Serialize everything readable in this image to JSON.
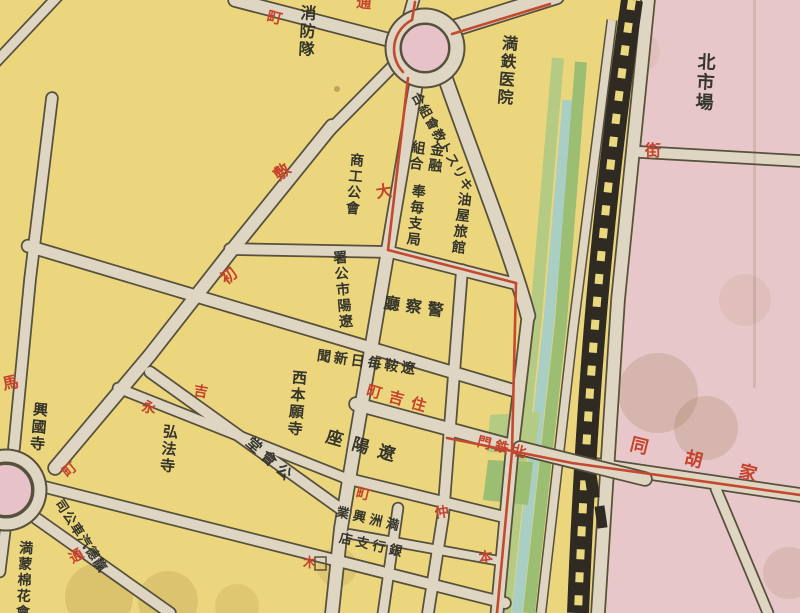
{
  "colors": {
    "paper_yellow": "#ebd67d",
    "district_pink": "#e8c7ca",
    "roundabout_pink": "#e7c3c9",
    "road_fill": "#ded5c2",
    "road_casing": "#56503c",
    "green_strip_light": "#b5ca82",
    "green_strip_dark": "#9cbe73",
    "canal_teal": "#a9cfc4",
    "railway_black": "#2f2b22",
    "railway_dash_yellow": "#ead87f",
    "ink_black": "#35352c",
    "ink_red": "#c5432d",
    "tram_red": "#c5492f"
  },
  "labels": [
    {
      "name": "fire-brigade-label",
      "display": "消防隊",
      "reading": "消防隊",
      "color": "black",
      "dir": "v",
      "x": 297,
      "y": 4,
      "size": 16,
      "rot": 3
    },
    {
      "name": "mantetsu-hospital-label",
      "display": "満鉄医院",
      "reading": "満鉄医院",
      "color": "black",
      "dir": "v",
      "x": 499,
      "y": 34,
      "size": 16,
      "rot": 5
    },
    {
      "name": "christian-church-union-label",
      "display": "合組會教トスリキ",
      "reading": "キリスト教會組合",
      "color": "black",
      "dir": "h",
      "x": 421,
      "y": 90,
      "size": 13,
      "rot": 61
    },
    {
      "name": "finance-coop-label-right",
      "display": "金融",
      "reading": "金融",
      "color": "black",
      "dir": "v",
      "x": 429,
      "y": 141,
      "size": 14,
      "rot": 8
    },
    {
      "name": "finance-coop-label-left",
      "display": "組合",
      "reading": "組合",
      "color": "black",
      "dir": "v",
      "x": 410,
      "y": 139,
      "size": 14,
      "rot": 8
    },
    {
      "name": "homai-branch-office-label",
      "display": "奉毎支局",
      "reading": "奉毎支局",
      "color": "black",
      "dir": "v",
      "x": 410,
      "y": 183,
      "size": 14,
      "rot": 6
    },
    {
      "name": "aburaya-ryokan-label",
      "display": "油屋旅館",
      "reading": "油屋旅館",
      "color": "black",
      "dir": "v",
      "x": 456,
      "y": 191,
      "size": 14,
      "rot": 7
    },
    {
      "name": "police-hq-label",
      "display": "廳察警",
      "reading": "警察廳",
      "color": "black",
      "dir": "h",
      "x": 385,
      "y": 295,
      "size": 16,
      "rot": 8,
      "spacing": 6
    },
    {
      "name": "liaoan-mainichi-newspaper-label",
      "display": "聞新日毎鞍遼",
      "reading": "遼鞍毎日新聞",
      "color": "black",
      "dir": "h",
      "x": 318,
      "y": 349,
      "size": 14,
      "rot": 8,
      "spacing": 3
    },
    {
      "name": "liaoyang-city-office-label",
      "display": "署公市陽遼",
      "reading": "遼陽市公署",
      "color": "black",
      "dir": "v",
      "x": 330,
      "y": 251,
      "size": 14,
      "rot": -5
    },
    {
      "name": "chamber-of-commerce-label",
      "display": "商工公會",
      "reading": "商工公會",
      "color": "black",
      "dir": "v",
      "x": 348,
      "y": 152,
      "size": 14,
      "rot": 5
    },
    {
      "name": "north-market-label",
      "display": "北市場",
      "reading": "北市場",
      "color": "black",
      "dir": "v",
      "x": 696,
      "y": 52,
      "size": 18,
      "rot": 3
    },
    {
      "name": "nishi-honganji-label",
      "display": "西本願寺",
      "reading": "西本願寺",
      "color": "black",
      "dir": "v",
      "x": 290,
      "y": 369,
      "size": 15,
      "rot": 5
    },
    {
      "name": "kobo-ji-label",
      "display": "弘法寺",
      "reading": "弘法寺",
      "color": "black",
      "dir": "v",
      "x": 161,
      "y": 423,
      "size": 15,
      "rot": 5
    },
    {
      "name": "kokoku-ji-label",
      "display": "興國寺",
      "reading": "興國寺",
      "color": "black",
      "dir": "v",
      "x": 31,
      "y": 401,
      "size": 15,
      "rot": 5
    },
    {
      "name": "public-hall-label",
      "display": "堂會公",
      "reading": "公會堂",
      "color": "black",
      "dir": "h",
      "x": 253,
      "y": 435,
      "size": 15,
      "rot": 42,
      "spacing": 5
    },
    {
      "name": "liaoyang-za-theater-label",
      "display": "座陽遼",
      "reading": "遼陽座",
      "color": "black",
      "dir": "h",
      "x": 329,
      "y": 427,
      "size": 17,
      "rot": 16,
      "spacing": 10
    },
    {
      "name": "manshu-kogyo-bank-label-line1",
      "display": "業興洲満",
      "reading": "満洲興業",
      "color": "black",
      "dir": "h",
      "x": 338,
      "y": 505,
      "size": 13,
      "rot": 13,
      "spacing": 4
    },
    {
      "name": "manshu-kogyo-bank-label-line2",
      "display": "店支行銀",
      "reading": "銀行支店",
      "color": "black",
      "dir": "h",
      "x": 341,
      "y": 531,
      "size": 13,
      "rot": 13,
      "spacing": 4
    },
    {
      "name": "tiande-motor-company-label",
      "display": "司公車汽德靝",
      "reading": "靝德汽車公司",
      "color": "black",
      "dir": "h",
      "x": 64,
      "y": 497,
      "size": 13,
      "rot": 57
    },
    {
      "name": "manmo-cotton-company-label",
      "display": "満蒙棉花會",
      "reading": "満蒙棉花會",
      "color": "black",
      "dir": "v",
      "x": 17,
      "y": 540,
      "size": 14,
      "rot": 3
    },
    {
      "name": "street-machi-label-nw",
      "display": "町",
      "reading": "町",
      "color": "red",
      "dir": "h",
      "x": 269,
      "y": 9,
      "size": 15,
      "rot": 14
    },
    {
      "name": "street-tori-label-top",
      "display": "通",
      "reading": "通",
      "color": "red",
      "dir": "h",
      "x": 357,
      "y": -5,
      "size": 15,
      "rot": 5
    },
    {
      "name": "street-shiki-label",
      "display": "敷",
      "reading": "敷",
      "color": "red",
      "dir": "h",
      "x": 271,
      "y": 171,
      "size": 16,
      "rot": -39
    },
    {
      "name": "street-hatsu-label",
      "display": "初",
      "reading": "初",
      "color": "red",
      "dir": "h",
      "x": 218,
      "y": 275,
      "size": 16,
      "rot": -39
    },
    {
      "name": "street-dai-label",
      "display": "大",
      "reading": "大",
      "color": "red",
      "dir": "h",
      "x": 375,
      "y": 185,
      "size": 16,
      "rot": -8
    },
    {
      "name": "street-uma-label",
      "display": "馬",
      "reading": "馬",
      "color": "red",
      "dir": "h",
      "x": 1,
      "y": 377,
      "size": 16,
      "rot": -12
    },
    {
      "name": "street-kichi-label",
      "display": "吉",
      "reading": "吉",
      "color": "red",
      "dir": "h",
      "x": 195,
      "y": 384,
      "size": 14,
      "rot": 10
    },
    {
      "name": "street-ei-label",
      "display": "永",
      "reading": "永",
      "color": "red",
      "dir": "h",
      "x": 143,
      "y": 400,
      "size": 14,
      "rot": 10
    },
    {
      "name": "street-machi-label-w",
      "display": "町",
      "reading": "町",
      "color": "red",
      "dir": "h",
      "x": 60,
      "y": 469,
      "size": 14,
      "rot": -39
    },
    {
      "name": "street-tori-label-sw",
      "display": "通",
      "reading": "通",
      "color": "red",
      "dir": "h",
      "x": 67,
      "y": 554,
      "size": 14,
      "rot": -30
    },
    {
      "name": "sumiyoshi-cho-label",
      "display": "町吉住",
      "reading": "住吉町",
      "color": "red",
      "dir": "h",
      "x": 369,
      "y": 383,
      "size": 15,
      "rot": 16,
      "spacing": 8
    },
    {
      "name": "street-machi-label-c",
      "display": "町",
      "reading": "町",
      "color": "red",
      "dir": "h",
      "x": 358,
      "y": 486,
      "size": 14,
      "rot": 14
    },
    {
      "name": "street-naka-label",
      "display": "仲",
      "reading": "仲",
      "color": "red",
      "dir": "h",
      "x": 434,
      "y": 507,
      "size": 14,
      "rot": -8
    },
    {
      "name": "kitetsumon-gate-label",
      "display": "門鉄北",
      "reading": "北鉄門",
      "color": "red",
      "dir": "h",
      "x": 479,
      "y": 435,
      "size": 14,
      "rot": 14,
      "spacing": 4
    },
    {
      "name": "jia-hutong-label",
      "display": "同胡家",
      "reading": "家胡同",
      "color": "red",
      "dir": "h",
      "x": 633,
      "y": 434,
      "size": 18,
      "rot": 14,
      "spacing": 38
    },
    {
      "name": "street-gai-label",
      "display": "街",
      "reading": "街",
      "color": "red",
      "dir": "h",
      "x": 645,
      "y": 143,
      "size": 16,
      "rot": 0
    },
    {
      "name": "street-hon-label",
      "display": "本",
      "reading": "本",
      "color": "red",
      "dir": "h",
      "x": 478,
      "y": 552,
      "size": 14,
      "rot": -8
    },
    {
      "name": "shrine-mark-label",
      "display": "木",
      "reading": "木",
      "color": "red",
      "dir": "h",
      "x": 303,
      "y": 556,
      "size": 13,
      "rot": 0
    }
  ]
}
